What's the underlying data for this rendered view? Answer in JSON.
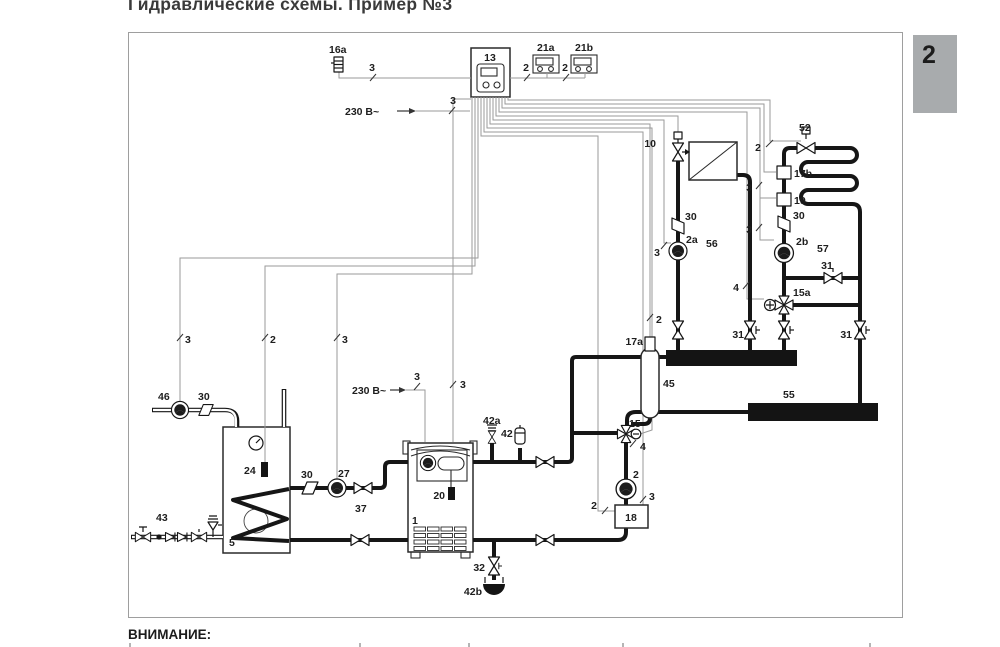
{
  "page": {
    "title": "Гидравлические схемы. Пример №3",
    "tab": "2",
    "attention": "ВНИМАНИЕ:",
    "tab_bg": "#a8abad",
    "pipe_color": "#161616",
    "wire_color": "#9a9a9a"
  },
  "labels": {
    "c16a": "16a",
    "c13": "13",
    "c21a": "21a",
    "c21b": "21b",
    "volt": "230 В~",
    "c10": "10",
    "c30": "30",
    "c2a": "2a",
    "c56": "56",
    "c52": "52",
    "c17b": "17b",
    "c19": "19",
    "c2b": "2b",
    "c57": "57",
    "c31": "31",
    "c15a": "15a",
    "c17a": "17a",
    "c45": "45",
    "c55": "55",
    "c46": "46",
    "c24": "24",
    "c43": "43",
    "c5": "5",
    "c27": "27",
    "c37": "37",
    "c1": "1",
    "c20": "20",
    "c42a": "42a",
    "c42": "42",
    "c32": "32",
    "c42b": "42b",
    "c15": "15",
    "c2": "2",
    "c18": "18",
    "w2": "2",
    "w3": "3",
    "w4": "4"
  }
}
